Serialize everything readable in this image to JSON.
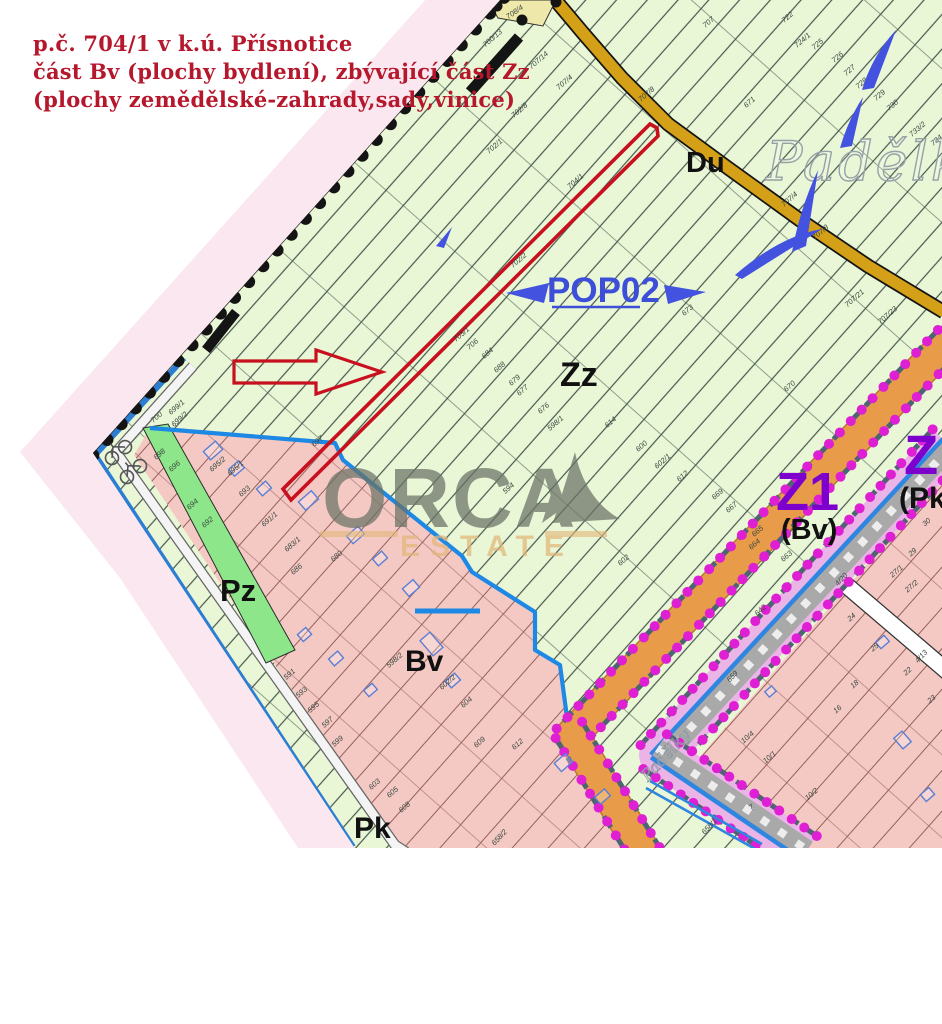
{
  "header": {
    "line1": "p.č. 704/1 v k.ú. Přísnotice",
    "line2": "část Bv (plochy bydlení), zbývající část Zz",
    "line3": "(plochy zemědělské-zahrady,sady,vinice)",
    "color": "#b5182d"
  },
  "watermark": {
    "brand": "ORCA",
    "sub": "ESTATE"
  },
  "map": {
    "labels_big": {
      "du": "Du",
      "padelky": "Padělky",
      "padelky2": "Padělky",
      "pop02": "POP02",
      "zz": "Zz",
      "z1": "Z1",
      "z1_sub": "(Bv)",
      "z2": "Z",
      "z2_sub": "(Pk",
      "pz": "Pz",
      "bv": "Bv",
      "pk": "Pk"
    },
    "colors": {
      "fade_pink": "#fbe7f0",
      "green_bg": "#e9f7d6",
      "hatch": "#46564e",
      "pink_bv": "#f4c9c4",
      "pink_line": "#95605b",
      "road_yellow": "#d4a017",
      "road_yellow_pale": "#eee8aa",
      "orange": "#e89c4a",
      "orange_edge": "#b8772e",
      "mauve": "#b59a97",
      "pz_green": "#8de68a",
      "bold_blue": "#1e88e5",
      "boundary_blue": "#2d7dd2",
      "violet": "#eab4e6",
      "gray_band": "#a9a9a9",
      "stream_blue": "#2f86e0",
      "magenta": "#df1fd3",
      "slate": "#4f6472",
      "purple": "#7d00cc",
      "pop_blue": "#3d4ed8",
      "red": "#c8101e",
      "watermark_gray": "#6b7265",
      "watermark_tan": "#e2b679",
      "label_green_area": "#39463f",
      "label_pink_area": "#5a3b38",
      "black": "#141414"
    },
    "parcel_labels": [
      {
        "t": "708/4",
        "x": 516,
        "y": 14,
        "r": -35
      },
      {
        "t": "700/13",
        "x": 494,
        "y": 40
      },
      {
        "t": "707/14",
        "x": 540,
        "y": 62
      },
      {
        "t": "707/4",
        "x": 566,
        "y": 84
      },
      {
        "t": "707/8",
        "x": 648,
        "y": 96
      },
      {
        "t": "702/8",
        "x": 521,
        "y": 112
      },
      {
        "t": "702/1",
        "x": 496,
        "y": 148
      },
      {
        "t": "702/2",
        "x": 520,
        "y": 262
      },
      {
        "t": "704/1",
        "x": 577,
        "y": 183
      },
      {
        "t": "705/1",
        "x": 463,
        "y": 336
      },
      {
        "t": "706",
        "x": 474,
        "y": 346
      },
      {
        "t": "684",
        "x": 489,
        "y": 355
      },
      {
        "t": "688",
        "x": 501,
        "y": 369
      },
      {
        "t": "679",
        "x": 516,
        "y": 382
      },
      {
        "t": "677",
        "x": 524,
        "y": 392
      },
      {
        "t": "676",
        "x": 545,
        "y": 410
      },
      {
        "t": "598/1",
        "x": 557,
        "y": 425
      },
      {
        "t": "614",
        "x": 612,
        "y": 424
      },
      {
        "t": "600",
        "x": 643,
        "y": 448
      },
      {
        "t": "602/1",
        "x": 664,
        "y": 463
      },
      {
        "t": "612",
        "x": 684,
        "y": 478
      },
      {
        "t": "669",
        "x": 719,
        "y": 496
      },
      {
        "t": "667",
        "x": 733,
        "y": 509
      },
      {
        "t": "665",
        "x": 759,
        "y": 533
      },
      {
        "t": "664",
        "x": 756,
        "y": 546
      },
      {
        "t": "663",
        "x": 788,
        "y": 558
      },
      {
        "t": "602",
        "x": 625,
        "y": 562
      },
      {
        "t": "594",
        "x": 510,
        "y": 490
      },
      {
        "t": "642",
        "x": 762,
        "y": 612
      },
      {
        "t": "670",
        "x": 791,
        "y": 388
      },
      {
        "t": "707",
        "x": 710,
        "y": 24
      },
      {
        "t": "722",
        "x": 789,
        "y": 19
      },
      {
        "t": "724/1",
        "x": 804,
        "y": 42
      },
      {
        "t": "725",
        "x": 819,
        "y": 46
      },
      {
        "t": "726",
        "x": 839,
        "y": 59
      },
      {
        "t": "727",
        "x": 851,
        "y": 72
      },
      {
        "t": "728",
        "x": 863,
        "y": 85
      },
      {
        "t": "729",
        "x": 881,
        "y": 97
      },
      {
        "t": "730",
        "x": 894,
        "y": 107
      },
      {
        "t": "733/2",
        "x": 919,
        "y": 131
      },
      {
        "t": "734",
        "x": 938,
        "y": 142
      },
      {
        "t": "707/4",
        "x": 791,
        "y": 201
      },
      {
        "t": "707/8",
        "x": 822,
        "y": 234
      },
      {
        "t": "707/21",
        "x": 856,
        "y": 300
      },
      {
        "t": "707/23",
        "x": 889,
        "y": 317
      },
      {
        "t": "671",
        "x": 751,
        "y": 104
      },
      {
        "t": "673",
        "x": 689,
        "y": 312
      },
      {
        "t": "700",
        "x": 158,
        "y": 419
      },
      {
        "t": "699/1",
        "x": 178,
        "y": 409
      },
      {
        "t": "699/2",
        "x": 181,
        "y": 421
      },
      {
        "t": "697",
        "x": 319,
        "y": 443
      },
      {
        "t": "698",
        "x": 161,
        "y": 456
      },
      {
        "t": "696",
        "x": 176,
        "y": 468
      },
      {
        "t": "695/2",
        "x": 219,
        "y": 466
      },
      {
        "t": "695/1",
        "x": 237,
        "y": 470
      },
      {
        "t": "693",
        "x": 246,
        "y": 493
      },
      {
        "t": "694",
        "x": 194,
        "y": 506
      },
      {
        "t": "692",
        "x": 209,
        "y": 524
      },
      {
        "t": "691/1",
        "x": 271,
        "y": 521
      },
      {
        "t": "683/1",
        "x": 294,
        "y": 546
      },
      {
        "t": "686",
        "x": 298,
        "y": 571
      },
      {
        "t": "680",
        "x": 338,
        "y": 558
      },
      {
        "t": "598/2",
        "x": 396,
        "y": 662
      },
      {
        "t": "602/2",
        "x": 449,
        "y": 684
      },
      {
        "t": "604",
        "x": 468,
        "y": 704
      },
      {
        "t": "609",
        "x": 481,
        "y": 744
      },
      {
        "t": "612",
        "x": 519,
        "y": 746
      },
      {
        "t": "591",
        "x": 291,
        "y": 676
      },
      {
        "t": "593",
        "x": 303,
        "y": 694
      },
      {
        "t": "595",
        "x": 315,
        "y": 709
      },
      {
        "t": "597",
        "x": 329,
        "y": 724
      },
      {
        "t": "599",
        "x": 339,
        "y": 743
      },
      {
        "t": "603",
        "x": 376,
        "y": 786
      },
      {
        "t": "605",
        "x": 394,
        "y": 794
      },
      {
        "t": "608",
        "x": 406,
        "y": 809
      },
      {
        "t": "30",
        "x": 928,
        "y": 524
      },
      {
        "t": "29",
        "x": 914,
        "y": 554
      },
      {
        "t": "27/1",
        "x": 898,
        "y": 573
      },
      {
        "t": "27/2",
        "x": 913,
        "y": 588
      },
      {
        "t": "24",
        "x": 853,
        "y": 619
      },
      {
        "t": "25",
        "x": 876,
        "y": 649
      },
      {
        "t": "22",
        "x": 909,
        "y": 673
      },
      {
        "t": "23",
        "x": 933,
        "y": 701
      },
      {
        "t": "18",
        "x": 856,
        "y": 686
      },
      {
        "t": "16",
        "x": 839,
        "y": 711
      },
      {
        "t": "10/4",
        "x": 749,
        "y": 739
      },
      {
        "t": "10/1",
        "x": 771,
        "y": 759
      },
      {
        "t": "10/2",
        "x": 813,
        "y": 796
      },
      {
        "t": "7",
        "x": 753,
        "y": 809
      },
      {
        "t": "4/20",
        "x": 843,
        "y": 581,
        "r": -47
      },
      {
        "t": "4/13",
        "x": 923,
        "y": 658,
        "r": -47
      },
      {
        "t": "658/1",
        "x": 711,
        "y": 828,
        "r": -47
      },
      {
        "t": "658/2",
        "x": 501,
        "y": 839,
        "r": -47
      },
      {
        "t": "659",
        "x": 734,
        "y": 678,
        "r": -47
      }
    ],
    "buildings": [
      [
        205,
        445,
        16,
        11
      ],
      [
        230,
        464,
        13,
        9
      ],
      [
        258,
        484,
        12,
        9
      ],
      [
        300,
        495,
        17,
        11
      ],
      [
        348,
        530,
        15,
        10
      ],
      [
        374,
        554,
        12,
        9
      ],
      [
        404,
        583,
        14,
        10
      ],
      [
        425,
        634,
        13,
        20
      ],
      [
        299,
        630,
        11,
        9
      ],
      [
        330,
        654,
        12,
        9
      ],
      [
        365,
        686,
        11,
        8
      ],
      [
        556,
        757,
        15,
        11
      ],
      [
        596,
        792,
        13,
        9
      ],
      [
        877,
        638,
        11,
        8
      ],
      [
        897,
        733,
        11,
        14
      ],
      [
        922,
        790,
        11,
        9
      ],
      [
        766,
        688,
        9,
        7
      ],
      [
        447,
        676,
        12,
        9
      ]
    ]
  }
}
